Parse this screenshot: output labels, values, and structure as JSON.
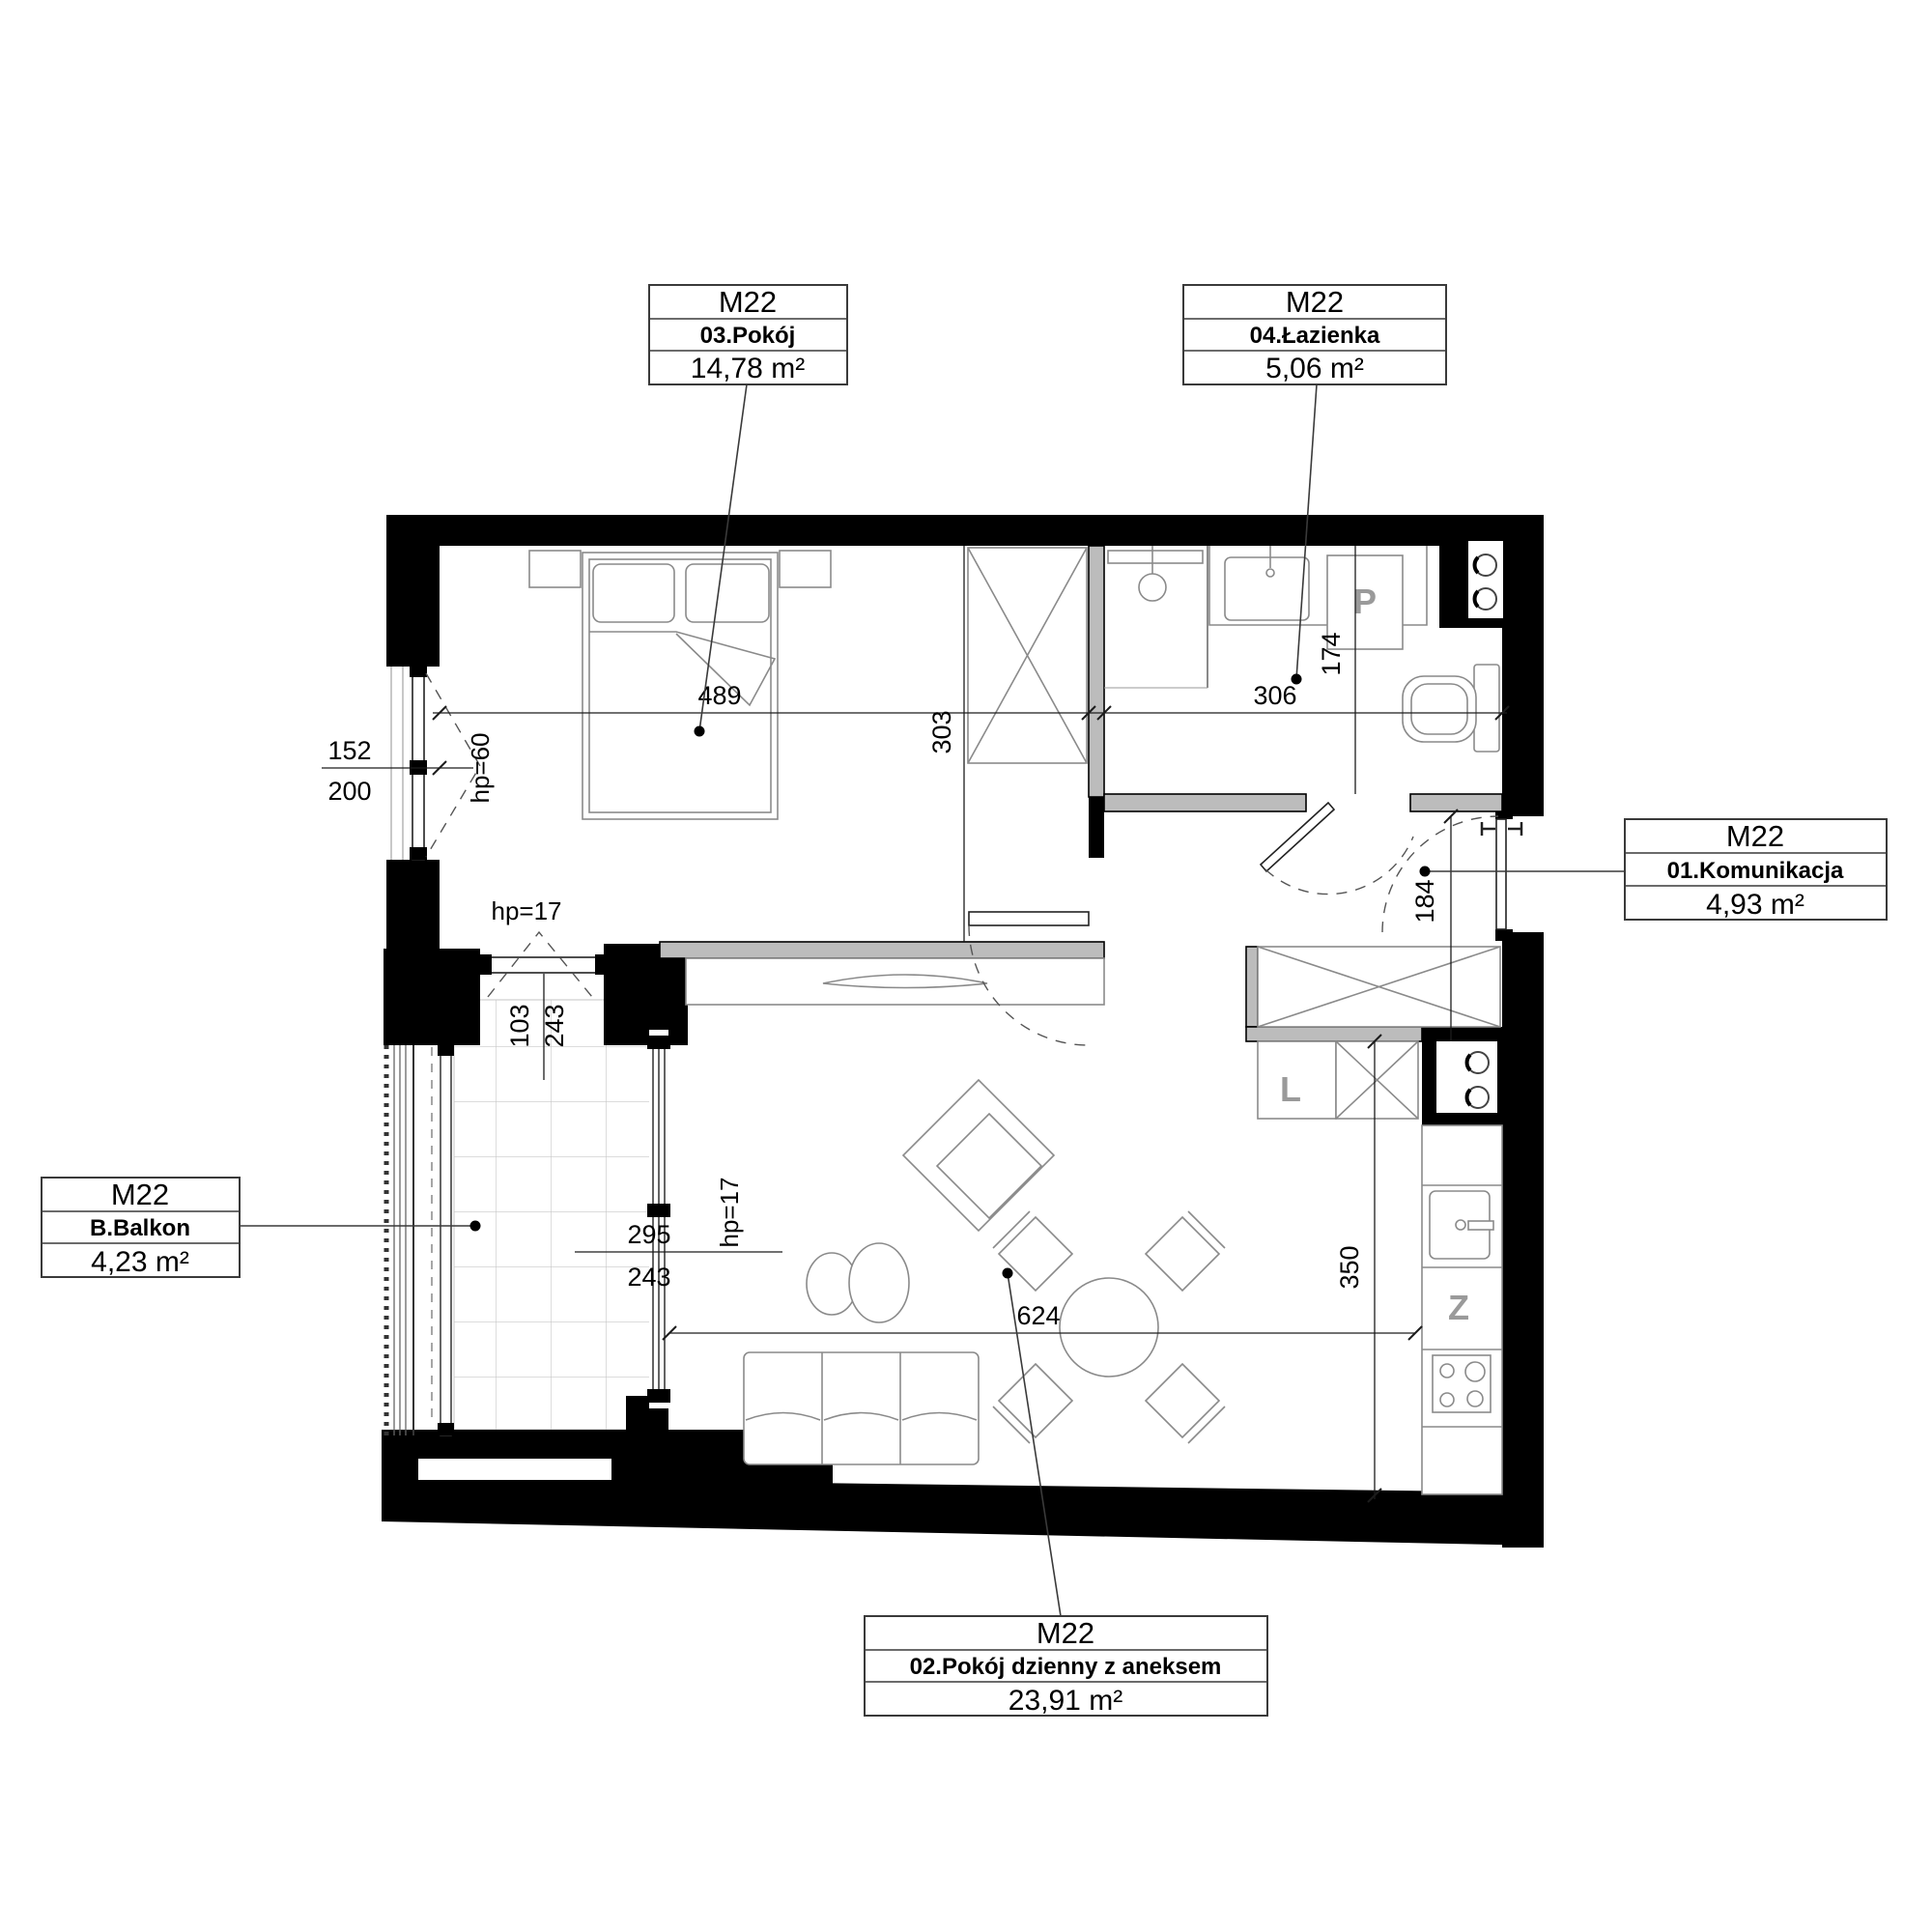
{
  "unit_label": "M22",
  "rooms": [
    {
      "unit": "M22",
      "room": "03.Pokój",
      "area": "14,78 m²"
    },
    {
      "unit": "M22",
      "room": "04.Łazienka",
      "area": "5,06 m²"
    },
    {
      "unit": "M22",
      "room": "01.Komunikacja",
      "area": "4,93 m²"
    },
    {
      "unit": "M22",
      "room": "B.Balkon",
      "area": "4,23 m²"
    },
    {
      "unit": "M22",
      "room": "02.Pokój dzienny z aneksem",
      "area": "23,91 m²"
    }
  ],
  "dims": {
    "d489": "489",
    "d303": "303",
    "d306": "306",
    "d174": "174",
    "d184": "184",
    "d350": "350",
    "d624": "624",
    "d152": "152",
    "d200": "200",
    "hp60": "hp=60",
    "d103": "103",
    "d243a": "243",
    "hp17a": "hp=17",
    "d295": "295",
    "d243b": "243",
    "hp17b": "hp=17"
  },
  "appliances": {
    "washing_machine": "P",
    "fridge": "L",
    "dishwasher": "Z"
  },
  "colors": {
    "wall": "#000000",
    "partition": "#bcbcbc",
    "furniture_line": "#8a8a8a"
  }
}
